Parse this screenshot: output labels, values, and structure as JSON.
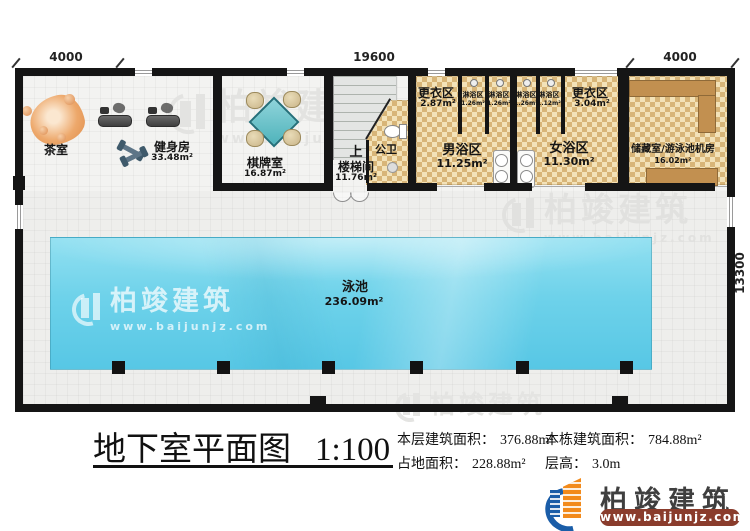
{
  "dimensions": {
    "top_left": "4000",
    "top_center": "19600",
    "top_right": "4000",
    "right_side": "13300"
  },
  "rooms": {
    "tea": {
      "name": "茶室"
    },
    "gym": {
      "name": "健身房",
      "area": "33.48m²"
    },
    "chess": {
      "name": "棋牌室",
      "area": "16.87m²"
    },
    "stairwell": {
      "direction": "上",
      "name": "楼梯间",
      "area": "11.76m²"
    },
    "toilet": {
      "name": "公卫"
    },
    "dressing_men": {
      "name": "更衣区",
      "area": "2.87m²"
    },
    "showers": [
      {
        "name": "淋浴区",
        "area": "1.26m²"
      },
      {
        "name": "淋浴区",
        "area": "1.26m²"
      },
      {
        "name": "淋浴区",
        "area": "1.26m²"
      },
      {
        "name": "淋浴区",
        "area": "1.12m²"
      }
    ],
    "men_bath": {
      "name": "男浴区",
      "area": "11.25m²"
    },
    "women_bath": {
      "name": "女浴区",
      "area": "11.30m²"
    },
    "dressing_women": {
      "name": "更衣区",
      "area": "3.04m²"
    },
    "storage": {
      "name": "储藏室/游泳池机房",
      "area": "16.02m²"
    },
    "pool": {
      "name": "泳池",
      "area": "236.09m²"
    }
  },
  "title": {
    "text": "地下室平面图",
    "scale": "1:100"
  },
  "stats": {
    "floor_area_label": "本层建筑面积：",
    "floor_area_value": "376.88m²",
    "building_area_label": "本栋建筑面积：",
    "building_area_value": "784.88m²",
    "land_area_label": "占地面积：",
    "land_area_value": "228.88m²",
    "height_label": "层高：",
    "height_value": "3.0m"
  },
  "brand": {
    "name": "柏竣建筑",
    "website": "www.baijunjz.com"
  },
  "colors": {
    "wall": "#151515",
    "checker_dark": "#d8b578",
    "checker_light": "#f3e2b8",
    "pool_blue": "#57c7e5",
    "counter_tan": "#c29050",
    "logo_blue": "#1a5da8",
    "logo_orange": "#f28a1b",
    "url_bar_red": "#8a3c2c",
    "watermark_gray": "#e2e2e0"
  }
}
